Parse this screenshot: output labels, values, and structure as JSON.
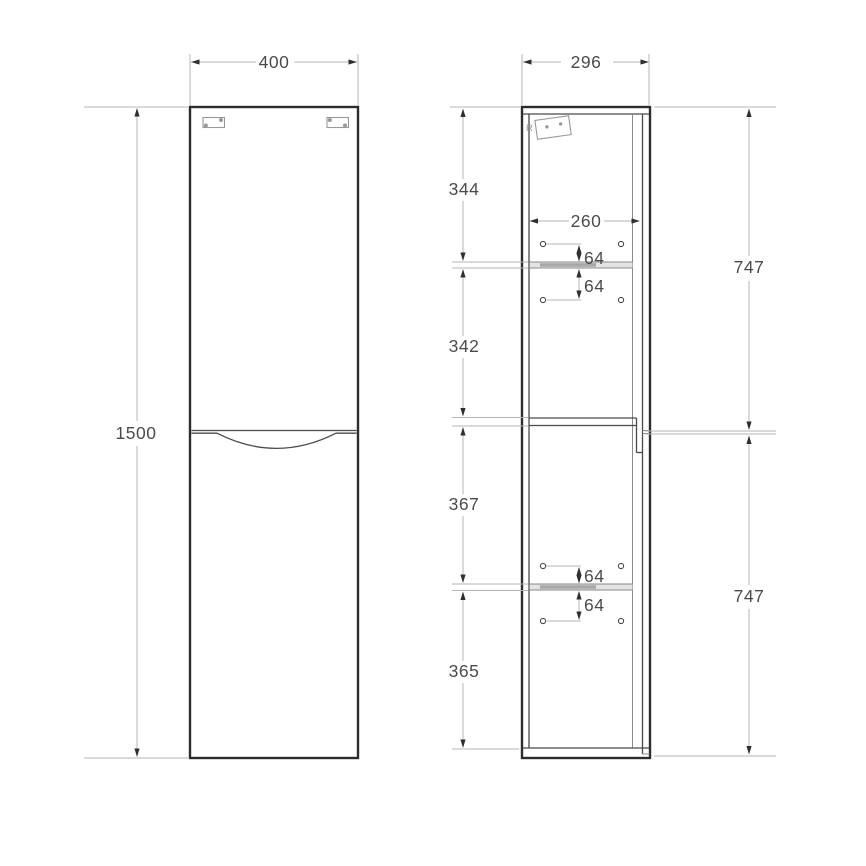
{
  "colors": {
    "outline": "#2d2d2d",
    "inner_line": "#4a4a4a",
    "detail_line": "#8a8a8a",
    "dim_line": "#b4b4b4",
    "dim_text": "#4b4b4b",
    "arrow": "#2f2f2f",
    "shelf_fill": "#e3e3e3",
    "shelf_dark": "#a8a8a8",
    "hardware": "#989898",
    "background": "#ffffff"
  },
  "dimensions": {
    "front_width": "400",
    "front_height": "1500",
    "side_depth": "296",
    "interior_depth": "260",
    "segments": {
      "top": "344",
      "upper_middle": "342",
      "lower_middle": "367",
      "bottom": "365"
    },
    "doors": {
      "upper": "747",
      "lower": "747"
    },
    "pin_offsets": {
      "upper_above": "64",
      "upper_below": "64",
      "lower_above": "64",
      "lower_below": "64"
    }
  },
  "annotations": {
    "bracket_mark": "R"
  }
}
